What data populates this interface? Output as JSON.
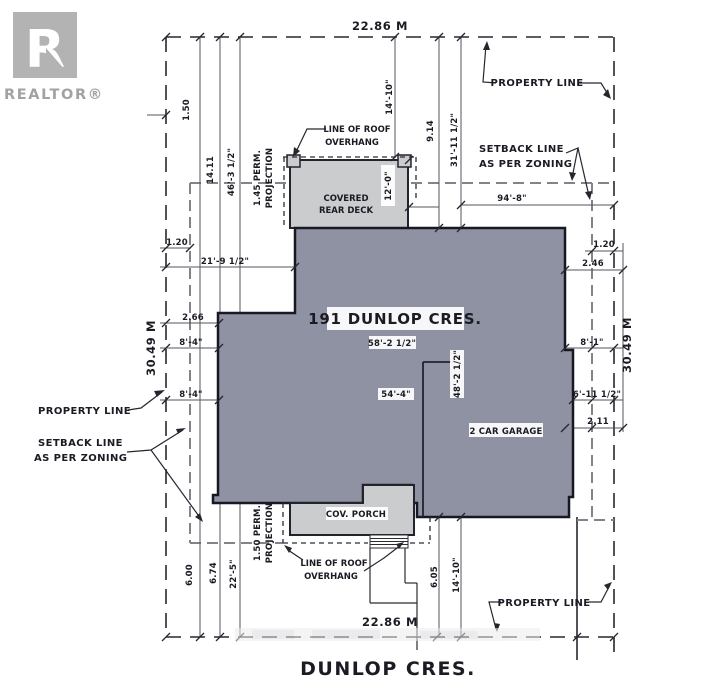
{
  "logo": {
    "letter": "R",
    "brand": "REALTOR®"
  },
  "callouts": {
    "property_line": "PROPERTY LINE",
    "setback_line": "SETBACK LINE",
    "as_per_zoning": "AS PER ZONING",
    "line_of_roof": "LINE OF ROOF",
    "overhang": "OVERHANG"
  },
  "building": {
    "house_label": "191 DUNLOP CRES.",
    "deck_line1": "COVERED",
    "deck_line2": "REAR DECK",
    "garage_label": "2 CAR GARAGE",
    "porch_label": "COV. PORCH",
    "street_label": "DUNLOP CRES."
  },
  "dimensions": {
    "top_width": "22.86 M",
    "bottom_width": "22.86 M",
    "left_depth": "30.49 M",
    "right_depth": "30.49 M",
    "left_150": "1.50",
    "left_1411": "14.11",
    "left_46": "46'-3 1/2\"",
    "left_perm": "1.45 PERM.",
    "left_perm2": "PROJECTION",
    "left_120": "1.20",
    "left_21": "21'-9 1/2\"",
    "left_266": "2.66",
    "left_84_upper": "8'-4\"",
    "left_84_lower": "8'-4\"",
    "top_1410": "14'-10\"",
    "top_914": "9.14",
    "top_31": "31'-11 1/2\"",
    "right_94": "94'-8\"",
    "right_120": "1.20",
    "right_246": "2.46",
    "right_81": "8'-1\"",
    "right_611": "6'-11 1/2\"",
    "right_211": "2.11",
    "deck_12": "12'-0\"",
    "house_58": "58'-2 1/2\"",
    "house_54": "54'-4\"",
    "house_48": "48'-2 1/2\"",
    "bottom_600": "6.00",
    "bottom_674": "6.74",
    "bottom_225": "22'-5\"",
    "bottom_perm": "1.50 PERM.",
    "bottom_perm2": "PROJECTION",
    "bottom_605": "6.05",
    "bottom_1410": "14'-10\""
  },
  "colors": {
    "house_fill": "#8F92A2",
    "deck_fill": "#CBCCCE",
    "line": "#26262F"
  }
}
